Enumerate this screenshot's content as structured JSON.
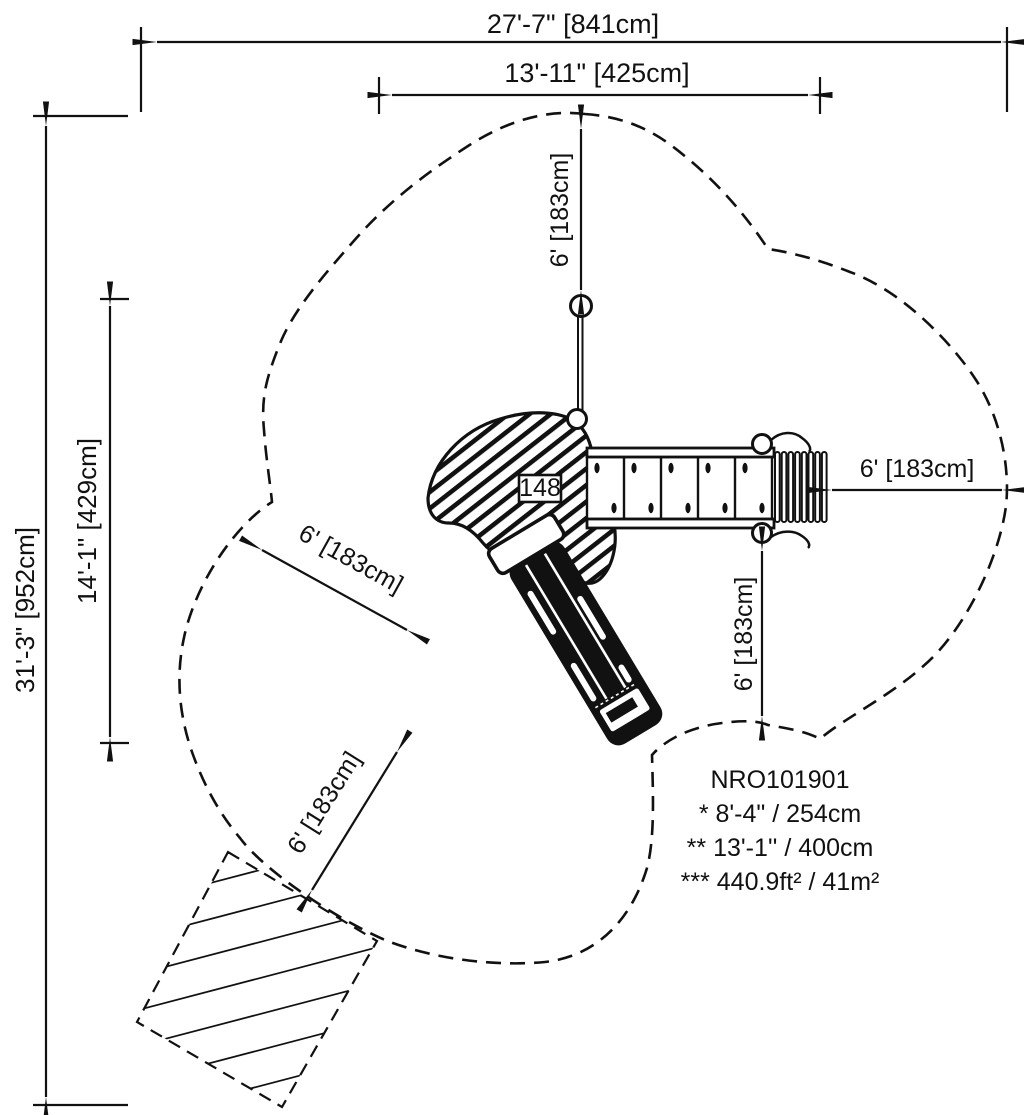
{
  "page": {
    "background": "#ffffff",
    "ink": "#111111"
  },
  "dimensions": {
    "overall_width": "27'-7\" [841cm]",
    "deck_span_width": "13'-11\" [425cm]",
    "overall_height": "31'-3\" [952cm]",
    "deck_span_height": "14'-1\" [429cm]",
    "use_zone_top": "6' [183cm]",
    "use_zone_right": "6' [183cm]",
    "use_zone_bottom_right": "6' [183cm]",
    "use_zone_slide_side": "6' [183cm]",
    "use_zone_slide_exit": "6' [183cm]"
  },
  "equipment": {
    "deck_number": "148"
  },
  "info_block": {
    "model": "NRO101901",
    "note1": "* 8'-4\" / 254cm",
    "note2": "** 13'-1'' / 400cm",
    "note3": "*** 440.9ft² / 41m²"
  }
}
